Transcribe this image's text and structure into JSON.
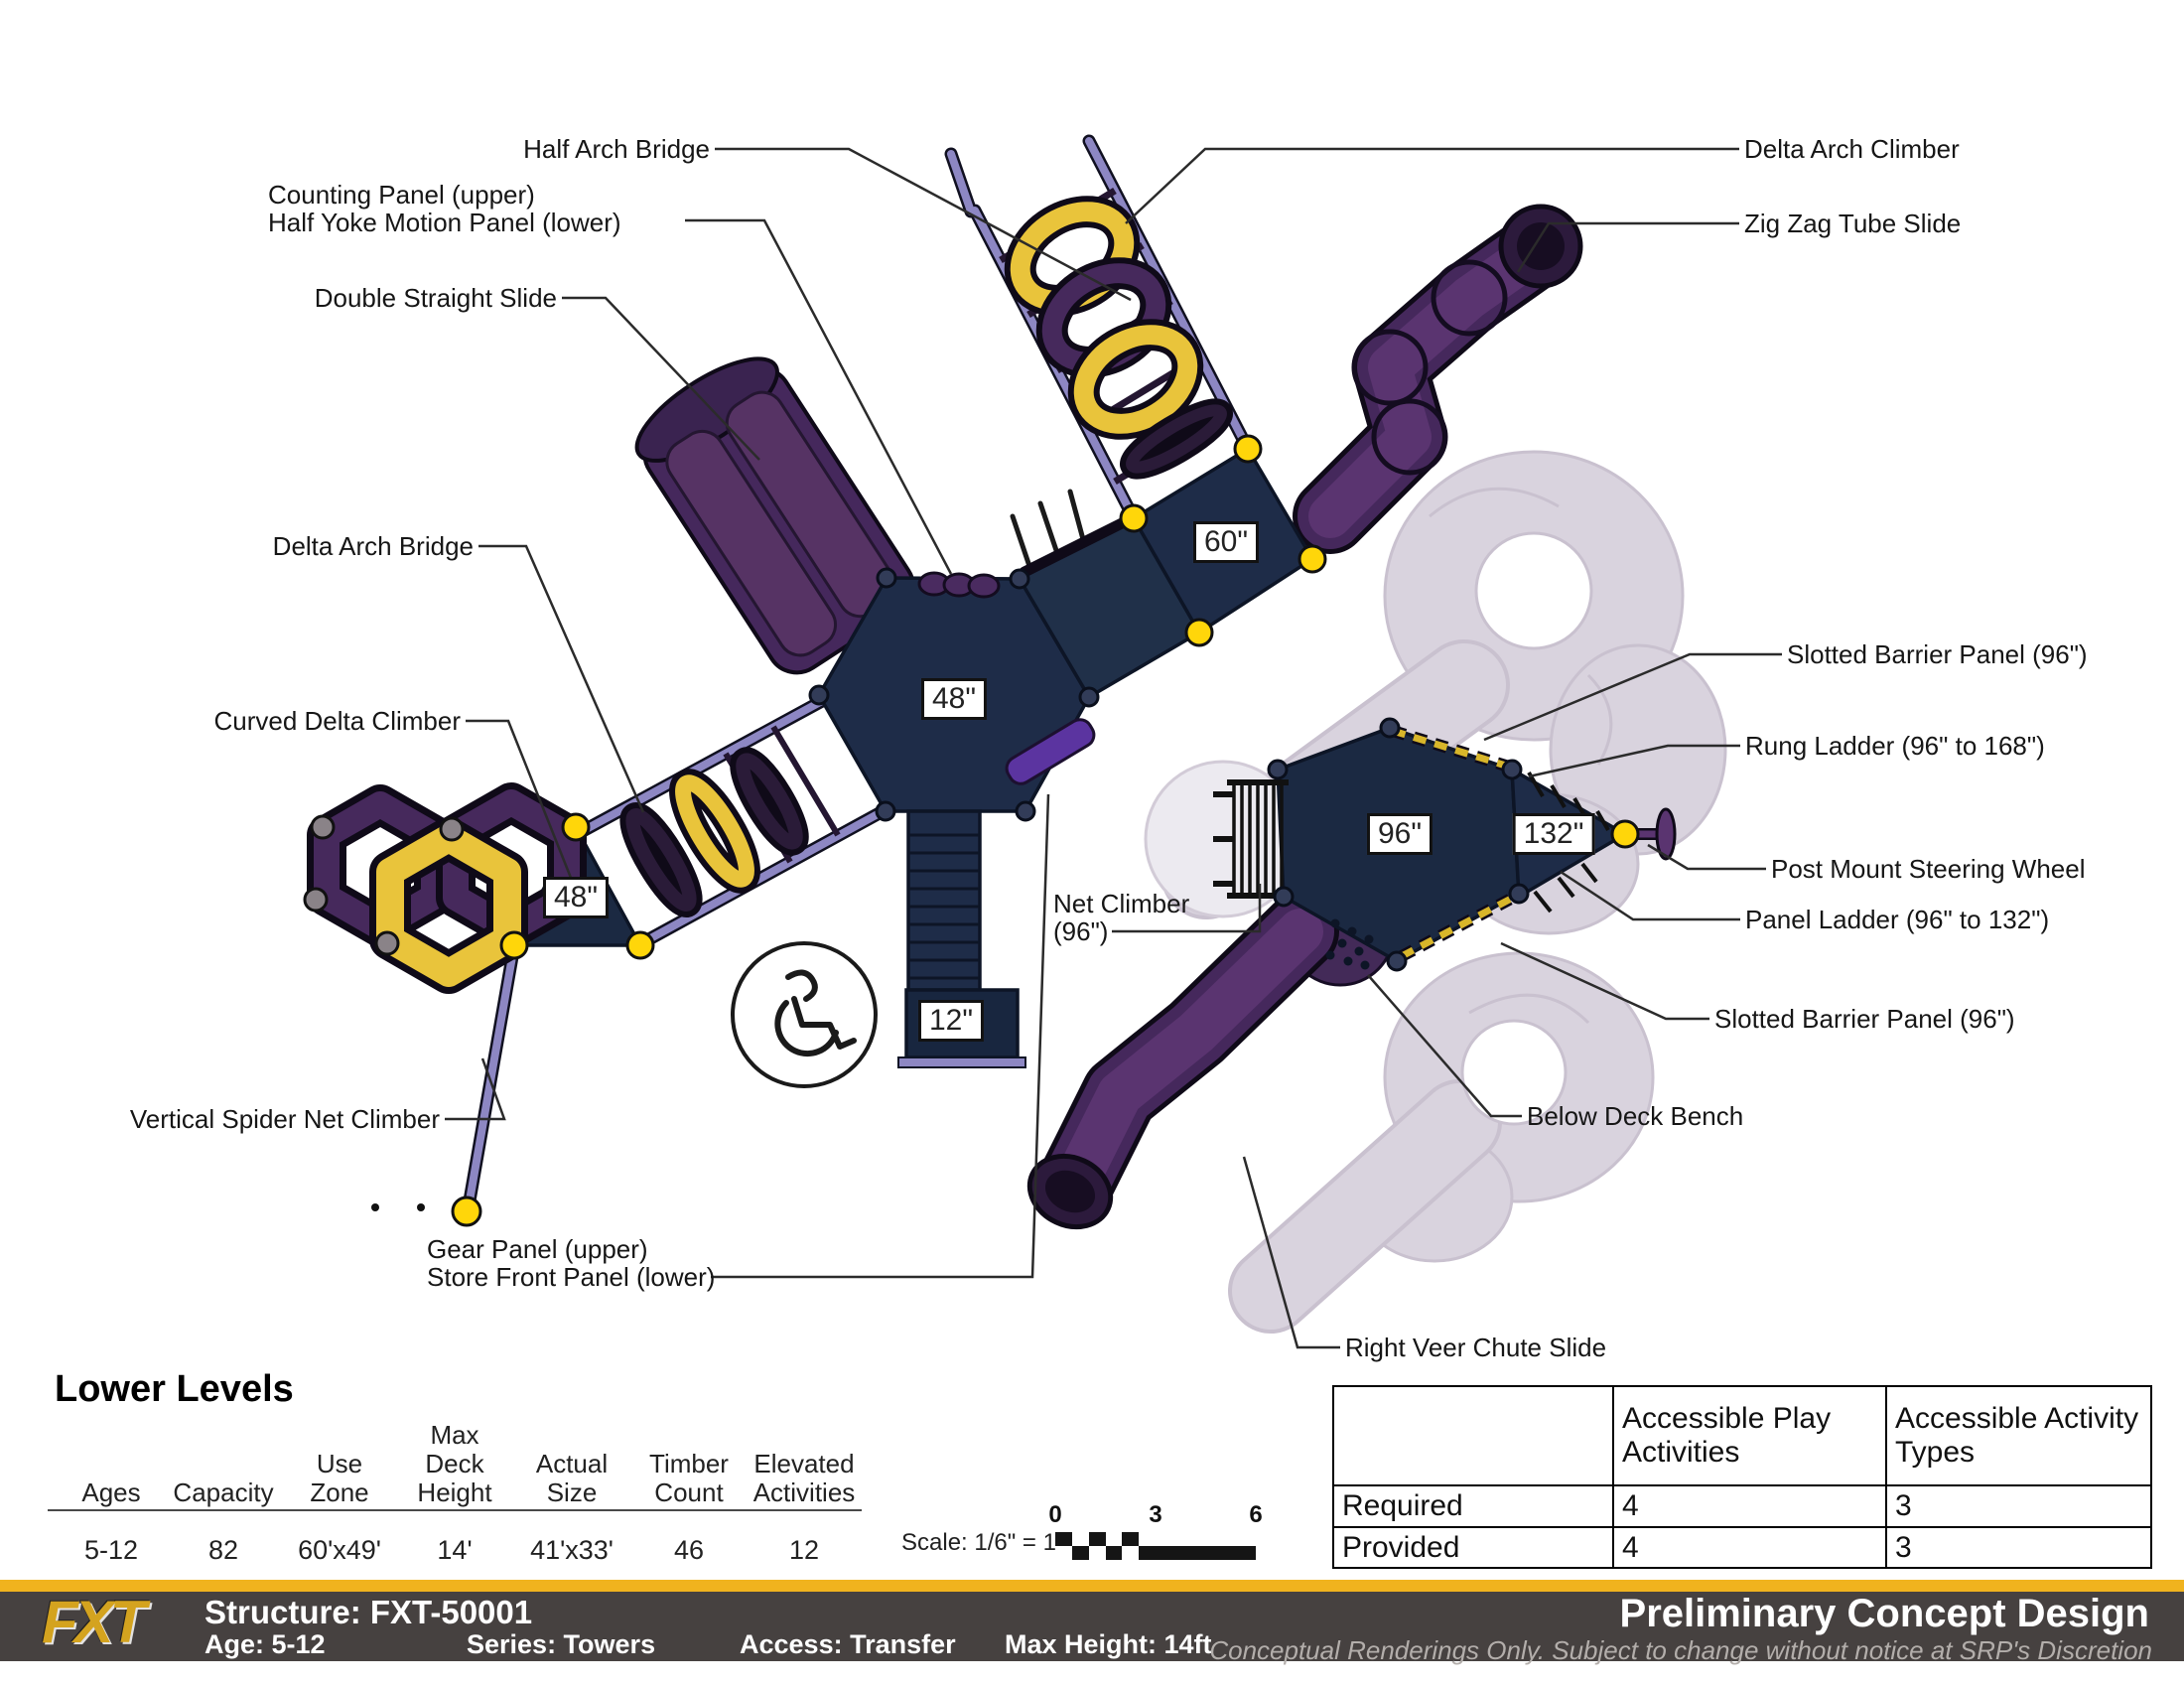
{
  "diagram": {
    "callouts": {
      "half_arch_bridge": "Half Arch Bridge",
      "counting_panel_l1": "Counting Panel (upper)",
      "counting_panel_l2": "Half Yoke Motion Panel (lower)",
      "double_straight_slide": "Double Straight Slide",
      "delta_arch_bridge": "Delta Arch Bridge",
      "curved_delta_climber": "Curved Delta Climber",
      "vertical_spider_net_climber": "Vertical Spider Net Climber",
      "delta_arch_climber": "Delta Arch Climber",
      "zig_zag_tube_slide": "Zig Zag Tube Slide",
      "slotted_barrier_panel_top": "Slotted Barrier Panel (96\")",
      "rung_ladder": "Rung Ladder (96\" to 168\")",
      "post_mount_steering_wheel": "Post Mount Steering Wheel",
      "panel_ladder": "Panel Ladder (96\" to 132\")",
      "slotted_barrier_panel_bottom": "Slotted Barrier Panel (96\")",
      "below_deck_bench": "Below Deck Bench",
      "right_veer_chute_slide": "Right Veer Chute Slide",
      "net_climber_l1": "Net Climber",
      "net_climber_l2": "(96\")",
      "gear_panel_l1": "Gear Panel (upper)",
      "gear_panel_l2": "Store Front Panel (lower)"
    },
    "deck_labels": {
      "d60": "60\"",
      "d48_hex": "48\"",
      "d48_tri": "48\"",
      "d96": "96\"",
      "d132": "132\"",
      "d12": "12\""
    },
    "scale": {
      "label": "Scale: 1/6\" = 1'",
      "ticks": [
        "0",
        "3",
        "6"
      ]
    }
  },
  "lower_levels": {
    "heading": "Lower Levels",
    "columns": [
      {
        "label": "Ages",
        "value": "5-12"
      },
      {
        "label": "Capacity",
        "value": "82"
      },
      {
        "label": "Use\nZone",
        "value": "60'x49'"
      },
      {
        "label": "Max\nDeck\nHeight",
        "value": "14'"
      },
      {
        "label": "Actual\nSize",
        "value": "41'x33'"
      },
      {
        "label": "Timber\nCount",
        "value": "46"
      },
      {
        "label": "Elevated\nActivities",
        "value": "12"
      }
    ]
  },
  "accessibility_table": {
    "headers": [
      "",
      "Accessible Play Activities",
      "Accessible Activity Types"
    ],
    "rows": [
      {
        "label": "Required",
        "values": [
          "4",
          "3"
        ]
      },
      {
        "label": "Provided",
        "values": [
          "4",
          "3"
        ]
      }
    ]
  },
  "footer": {
    "logo": "FXT",
    "structure": "Structure: FXT-50001",
    "age": "Age: 5-12",
    "series": "Series: Towers",
    "access": "Access: Transfer",
    "max_height": "Max Height: 14ft",
    "title": "Preliminary Concept Design",
    "disclaimer": "Conceptual Renderings Only. Subject to change without notice at SRP's Discretion"
  },
  "colors": {
    "deck_navy": "#1E2C48",
    "slide_purple": "#45285C",
    "rail_lavender": "#8D87C3",
    "accent_yellow": "#FFD60A",
    "ring_yellow": "#E9C43B",
    "ghost_gray": "#D9D3DE",
    "footer_gold": "#F0B31E",
    "footer_charcoal": "#464140"
  }
}
